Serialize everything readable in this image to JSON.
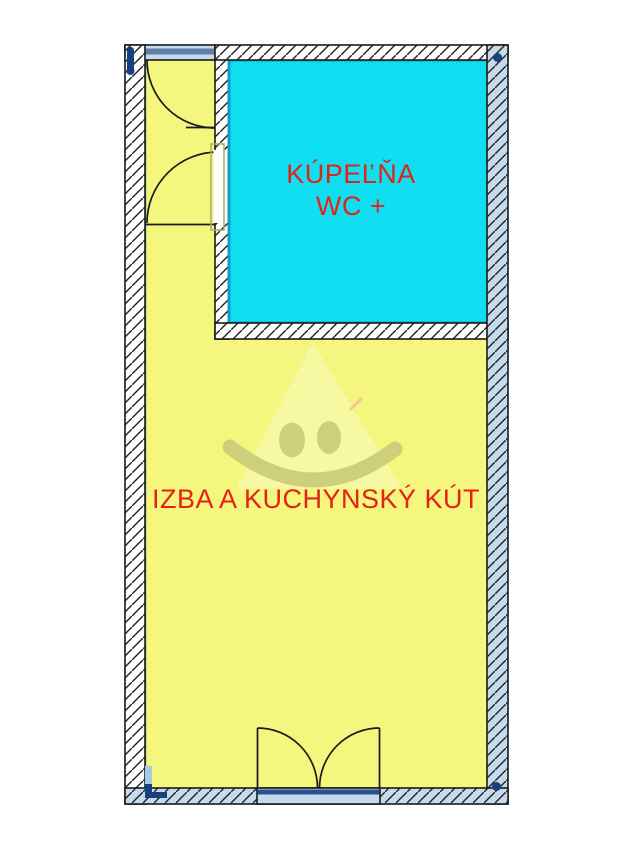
{
  "floorplan": {
    "rooms": [
      {
        "id": "kupelna-wc",
        "label_line1": "KÚPEĽŇA",
        "label_line2": "WC +",
        "fill": "#10dff2"
      },
      {
        "id": "izba-kuchynsky-kut",
        "label": "IZBA A KUCHYNSKÝ KÚT",
        "fill": "#f4f67e"
      }
    ],
    "colors": {
      "page_bg": "#ffffff",
      "room_bathroom": "#10dff2",
      "room_living": "#f4f67e",
      "room_label": "#e32219",
      "bathroom_border": "#0f9ec4",
      "living_border": "#5a8f7c",
      "wall_white": "#ffffff",
      "wall_blue": "#c5dbeb",
      "wall_edge": "#1a1a1a",
      "corner_marker": "#16407e",
      "lintel_band": "#5f80ab",
      "door_sill": "#2a4f8f",
      "door_jamb_frame": "#a9ab66",
      "watermark_face": "#cdcf7a",
      "watermark_cone": "#f7f8a2"
    }
  }
}
